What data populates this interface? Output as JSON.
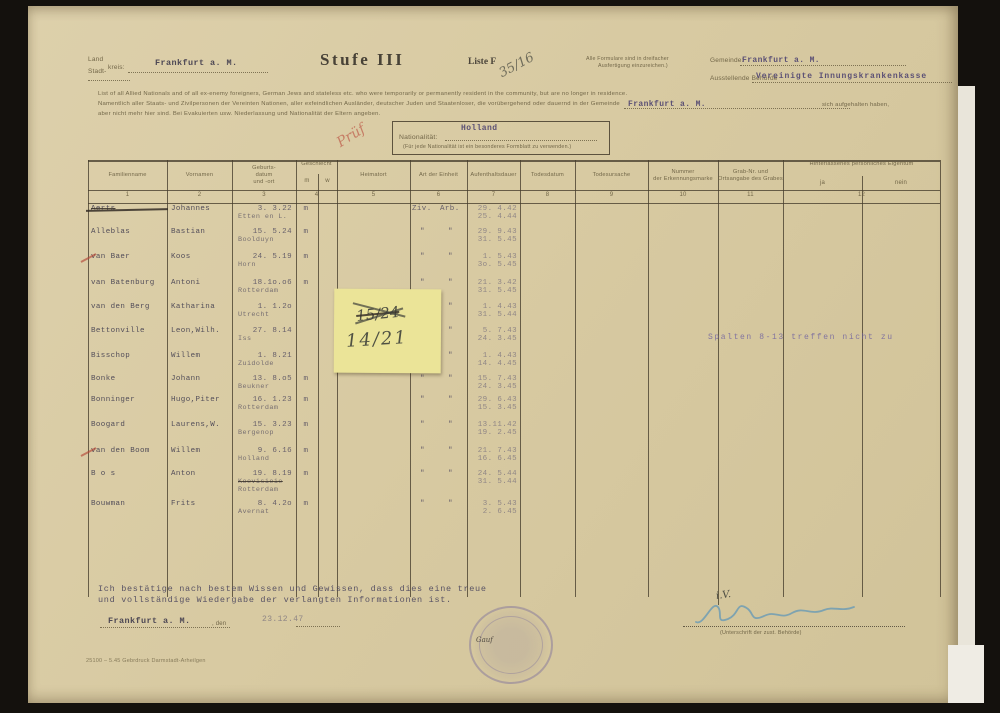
{
  "header": {
    "land_label": "Land",
    "stadt_label": "Stadt-",
    "kreis_label": "kreis:",
    "land_value": "Frankfurt a. M.",
    "title": "Stufe III",
    "liste_label": "Liste F",
    "liste_number_handwritten": "35/16",
    "formular_note_line1": "Alle Formulare sind in dreifacher",
    "formular_note_line2": "Ausfertigung einzureichen.)",
    "gemeinde_label": "Gemeinde:",
    "gemeinde_value": "Frankfurt a. M.",
    "behoerde_label": "Ausstellende Behörde",
    "behoerde_value": "Vereinigte Innungskrankenkasse"
  },
  "intro": {
    "line1": "List of all Allied Nationals and of all ex-enemy foreigners, German Jews and stateless etc. who were temporarily or permanently resident in the community, but are no longer in residence.",
    "line2": "Namentlich aller Staats- und Zivilpersonen der Vereinten Nationen, aller exfeindlichen Ausländer, deutscher Juden und Staatenloser, die vorübergehend oder dauernd in der Gemeinde",
    "gemeinde_inline_value": "Frankfurt a. M.",
    "line2_end": "sich aufgehalten haben,",
    "line3": "aber nicht mehr hier sind. Bei Evakuierten usw. Niederlassung und Nationalität der Eltern angeben."
  },
  "nationality_box": {
    "label": "Nationalität:",
    "value": "Holland",
    "note": "(Für jede Nationalität ist ein besonderes Formblatt zu verwenden.)",
    "red_mark": "Prüf"
  },
  "table": {
    "columns": [
      {
        "num": "1",
        "label": "Familienname"
      },
      {
        "num": "2",
        "label": "Vornamen"
      },
      {
        "num": "3",
        "label": "Geburts-\ndatum\nund -ort"
      },
      {
        "num": "4",
        "label": "Geschlecht",
        "sub_left": "m",
        "sub_right": "w"
      },
      {
        "num": "5",
        "label": "Heimatort"
      },
      {
        "num": "6",
        "label": "Art der Einheit"
      },
      {
        "num": "7",
        "label": "Aufenthaltsdauer"
      },
      {
        "num": "8",
        "label": "Todesdatum"
      },
      {
        "num": "9",
        "label": "Todesursache"
      },
      {
        "num": "10",
        "label": "Nummer\nder Erkennungsmarke"
      },
      {
        "num": "11",
        "label": "Grab-Nr. und\nOrtsangabe des Grabes"
      },
      {
        "num": "12",
        "label": "Hinterlassenes persönliches Eigentum",
        "sub_left": "ja",
        "sub_right": "nein"
      }
    ],
    "rows": [
      {
        "surname": "Aerts",
        "strike": true,
        "firstname": "Johannes",
        "birth": "3. 3.22",
        "birthplace": "Etten en L.",
        "sex": "m",
        "unit_l": "Ziv.",
        "unit_r": "Arb.",
        "stay_from": "29. 4.42",
        "stay_to": "25. 4.44"
      },
      {
        "surname": "Alleblas",
        "firstname": "Bastian",
        "birth": "15. 5.24",
        "birthplace": "Boolduyn",
        "sex": "m",
        "unit_l": "\"",
        "unit_r": "\"",
        "stay_from": "29. 9.43",
        "stay_to": "31. 5.45"
      },
      {
        "surname": "van Baer",
        "red_check": true,
        "firstname": "Koos",
        "birth": "24. 5.19",
        "birthplace": "Horn",
        "sex": "m",
        "unit_l": "\"",
        "unit_r": "\"",
        "stay_from": "1. 5.43",
        "stay_to": "3o. 5.45"
      },
      {
        "surname": "van Batenburg",
        "firstname": "Antoni",
        "birth": "18.1o.o6",
        "birthplace": "Rotterdam",
        "sex": "m",
        "unit_l": "\"",
        "unit_r": "\"",
        "stay_from": "21. 3.42",
        "stay_to": "31. 5.45"
      },
      {
        "surname": "van den Berg",
        "firstname": "Katharina",
        "birth": "1. 1.2o",
        "birthplace": "Utrecht",
        "sex": "",
        "unit_l": "\"",
        "unit_r": "\"",
        "stay_from": "1. 4.43",
        "stay_to": "31. 5.44"
      },
      {
        "surname": "Bettonville",
        "firstname": "Leon,Wilh.",
        "birth": "27. 8.14",
        "birthplace": "Iss",
        "sex": "",
        "unit_l": "\"",
        "unit_r": "\"",
        "stay_from": "5. 7.43",
        "stay_to": "24. 3.45"
      },
      {
        "surname": "Bisschop",
        "firstname": "Willem",
        "birth": "1. 8.21",
        "birthplace": "Zuidolde",
        "sex": "",
        "unit_l": "\"",
        "unit_r": "\"",
        "stay_from": "1. 4.43",
        "stay_to": "14. 4.45"
      },
      {
        "surname": "Bonke",
        "firstname": "Johann",
        "birth": "13. 8.o5",
        "birthplace": "Beukner",
        "sex": "m",
        "unit_l": "\"",
        "unit_r": "\"",
        "stay_from": "15. 7.43",
        "stay_to": "24. 3.45"
      },
      {
        "surname": "Bonninger",
        "firstname": "Hugo,Piter",
        "birth": "16. 1.23",
        "birthplace": "Rotterdam",
        "sex": "m",
        "unit_l": "\"",
        "unit_r": "\"",
        "stay_from": "29. 6.43",
        "stay_to": "15. 3.45"
      },
      {
        "surname": "Boogard",
        "firstname": "Laurens,W.",
        "birth": "15. 3.23",
        "birthplace": "Bergenop",
        "sex": "m",
        "unit_l": "\"",
        "unit_r": "\"",
        "stay_from": "13.11.42",
        "stay_to": "19. 2.45"
      },
      {
        "surname": "van den Boom",
        "red_check": true,
        "firstname": "Willem",
        "birth": "9. 6.16",
        "birthplace": "Holland",
        "sex": "m",
        "unit_l": "\"",
        "unit_r": "\"",
        "stay_from": "21. 7.43",
        "stay_to": "16. 6.45"
      },
      {
        "surname": "B o s",
        "firstname": "Anton",
        "birth": "19. 8.19",
        "birthplace_struck": "Koevisieie",
        "birthplace": "Rotterdam",
        "sex": "m",
        "unit_l": "\"",
        "unit_r": "\"",
        "stay_from": "24. 5.44",
        "stay_to": "31. 5.44"
      },
      {
        "surname": "Bouwman",
        "firstname": "Frits",
        "birth": "8. 4.2o",
        "birthplace": "Avernat",
        "sex": "m",
        "unit_l": "\"",
        "unit_r": "\"",
        "stay_from": "3. 5.43",
        "stay_to": "2. 6.45"
      }
    ],
    "stamp_note": "Spalten 8-13 treffen nicht zu"
  },
  "sticky_note": {
    "line1_struck": "15/24",
    "line2": "14/21"
  },
  "footer": {
    "cert_line1": "Ich bestätige nach bestem Wissen und Gewissen, dass dies eine treue",
    "cert_line2": "und vollständige Wiedergabe der verlangten Informationen ist.",
    "place_value": "Frankfurt a. M.",
    "den_label": ", den",
    "date_value": "23.12.47",
    "stamp_handwritten": "Gauf",
    "iv_handwritten": "i.V.",
    "signature_caption": "(Unterschrift der zust. Behörde)",
    "print_code": "25100 – 5.45   Gebrdruck Darmstadt-Arheilgen"
  }
}
